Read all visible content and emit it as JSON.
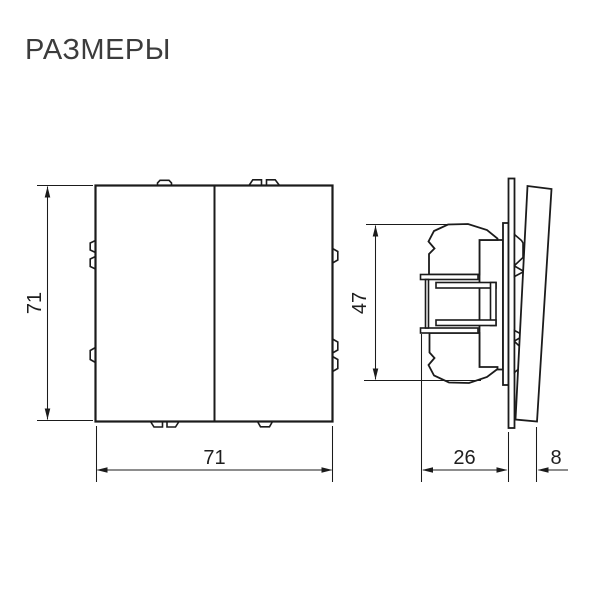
{
  "title": "РАЗМЕРЫ",
  "dimensions": {
    "front_height": "71",
    "front_width": "71",
    "side_height": "47",
    "side_depth": "26",
    "side_rocker_depth": "8"
  },
  "colors": {
    "background": "#ffffff",
    "line": "#1b1b1b",
    "title_text": "#3c3c3c",
    "dimension_text": "#1e1e1e"
  }
}
